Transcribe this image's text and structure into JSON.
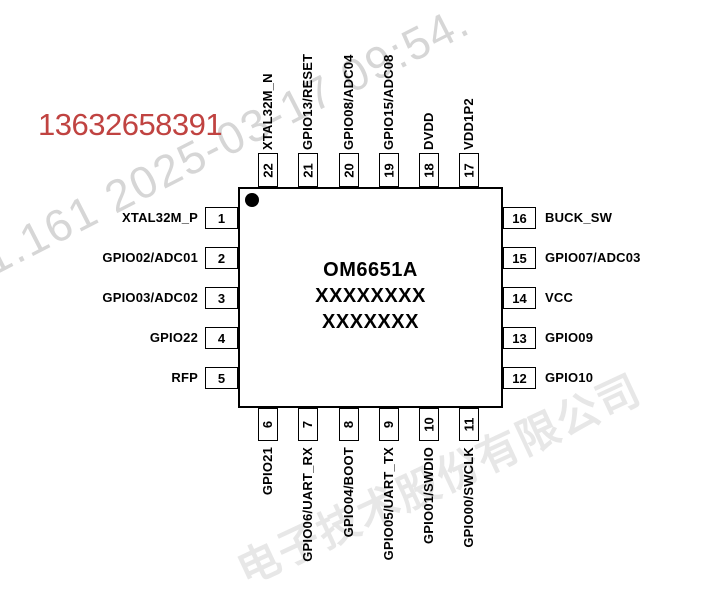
{
  "annotations": {
    "phone_number": "13632658391",
    "watermark_datetime": "1.161 2025-03-17 09:54.",
    "watermark_company": "电子技术股份有限公司"
  },
  "chip": {
    "title": "OM6651A",
    "marking_line2": "XXXXXXXX",
    "marking_line3": "XXXXXXX"
  },
  "pins": {
    "left": [
      {
        "number": "1",
        "label": "XTAL32M_P"
      },
      {
        "number": "2",
        "label": "GPIO02/ADC01"
      },
      {
        "number": "3",
        "label": "GPIO03/ADC02"
      },
      {
        "number": "4",
        "label": "GPIO22"
      },
      {
        "number": "5",
        "label": "RFP"
      }
    ],
    "right": [
      {
        "number": "16",
        "label": "BUCK_SW"
      },
      {
        "number": "15",
        "label": "GPIO07/ADC03"
      },
      {
        "number": "14",
        "label": "VCC"
      },
      {
        "number": "13",
        "label": "GPIO09"
      },
      {
        "number": "12",
        "label": "GPIO10"
      }
    ],
    "top": [
      {
        "number": "22",
        "label": "XTAL32M_N"
      },
      {
        "number": "21",
        "label": "GPIO13/RESET"
      },
      {
        "number": "20",
        "label": "GPIO08/ADC04"
      },
      {
        "number": "19",
        "label": "GPIO15/ADC08"
      },
      {
        "number": "18",
        "label": "DVDD"
      },
      {
        "number": "17",
        "label": "VDD1P2"
      }
    ],
    "bottom": [
      {
        "number": "6",
        "label": "GPIO21"
      },
      {
        "number": "7",
        "label": "GPIO06/UART_RX"
      },
      {
        "number": "8",
        "label": "GPIO04/BOOT"
      },
      {
        "number": "9",
        "label": "GPIO05/UART_TX"
      },
      {
        "number": "10",
        "label": "GPIO01/SWDIO"
      },
      {
        "number": "11",
        "label": "GPIO00/SWCLK"
      }
    ]
  },
  "colors": {
    "ink": "#000000",
    "phone_red": "#c04341",
    "watermark_gray": "#d6d6d6",
    "watermark_light_gray": "#e7e7e7"
  }
}
